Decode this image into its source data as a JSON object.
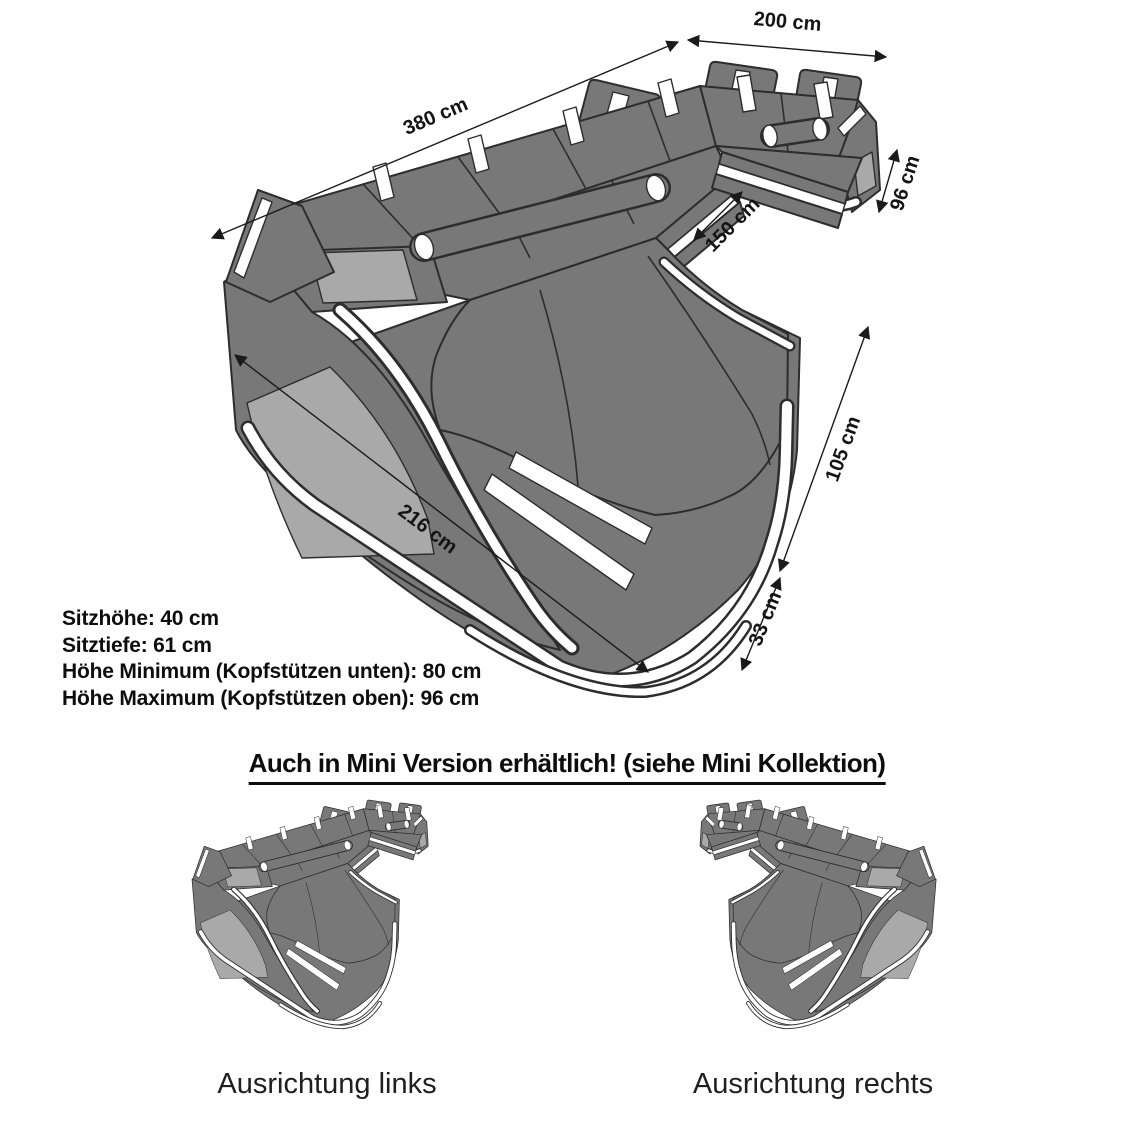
{
  "diagram": {
    "dimensions": {
      "d380": "380 cm",
      "d200": "200 cm",
      "d96": "96 cm",
      "d150": "150 cm",
      "d105": "105 cm",
      "d33": "33 cm",
      "d216": "216 cm"
    },
    "specs": {
      "lines": [
        "Sitzhöhe: 40 cm",
        "Sitztiefe: 61 cm",
        "Höhe Minimum (Kopfstützen unten): 80 cm",
        "Höhe Maximum (Kopfstützen oben): 96 cm"
      ]
    }
  },
  "mini_section": {
    "heading": "Auch in Mini Version erhältlich! (siehe Mini Kollektion)",
    "caption_left": "Ausrichtung links",
    "caption_right": "Ausrichtung rechts"
  },
  "colors": {
    "sofa_body": "#787878",
    "sofa_outline": "#2d2d2d",
    "sofa_inset": "#a9a9a9",
    "accent_stripe": "#ffffff",
    "text": "#0d0d0d"
  }
}
